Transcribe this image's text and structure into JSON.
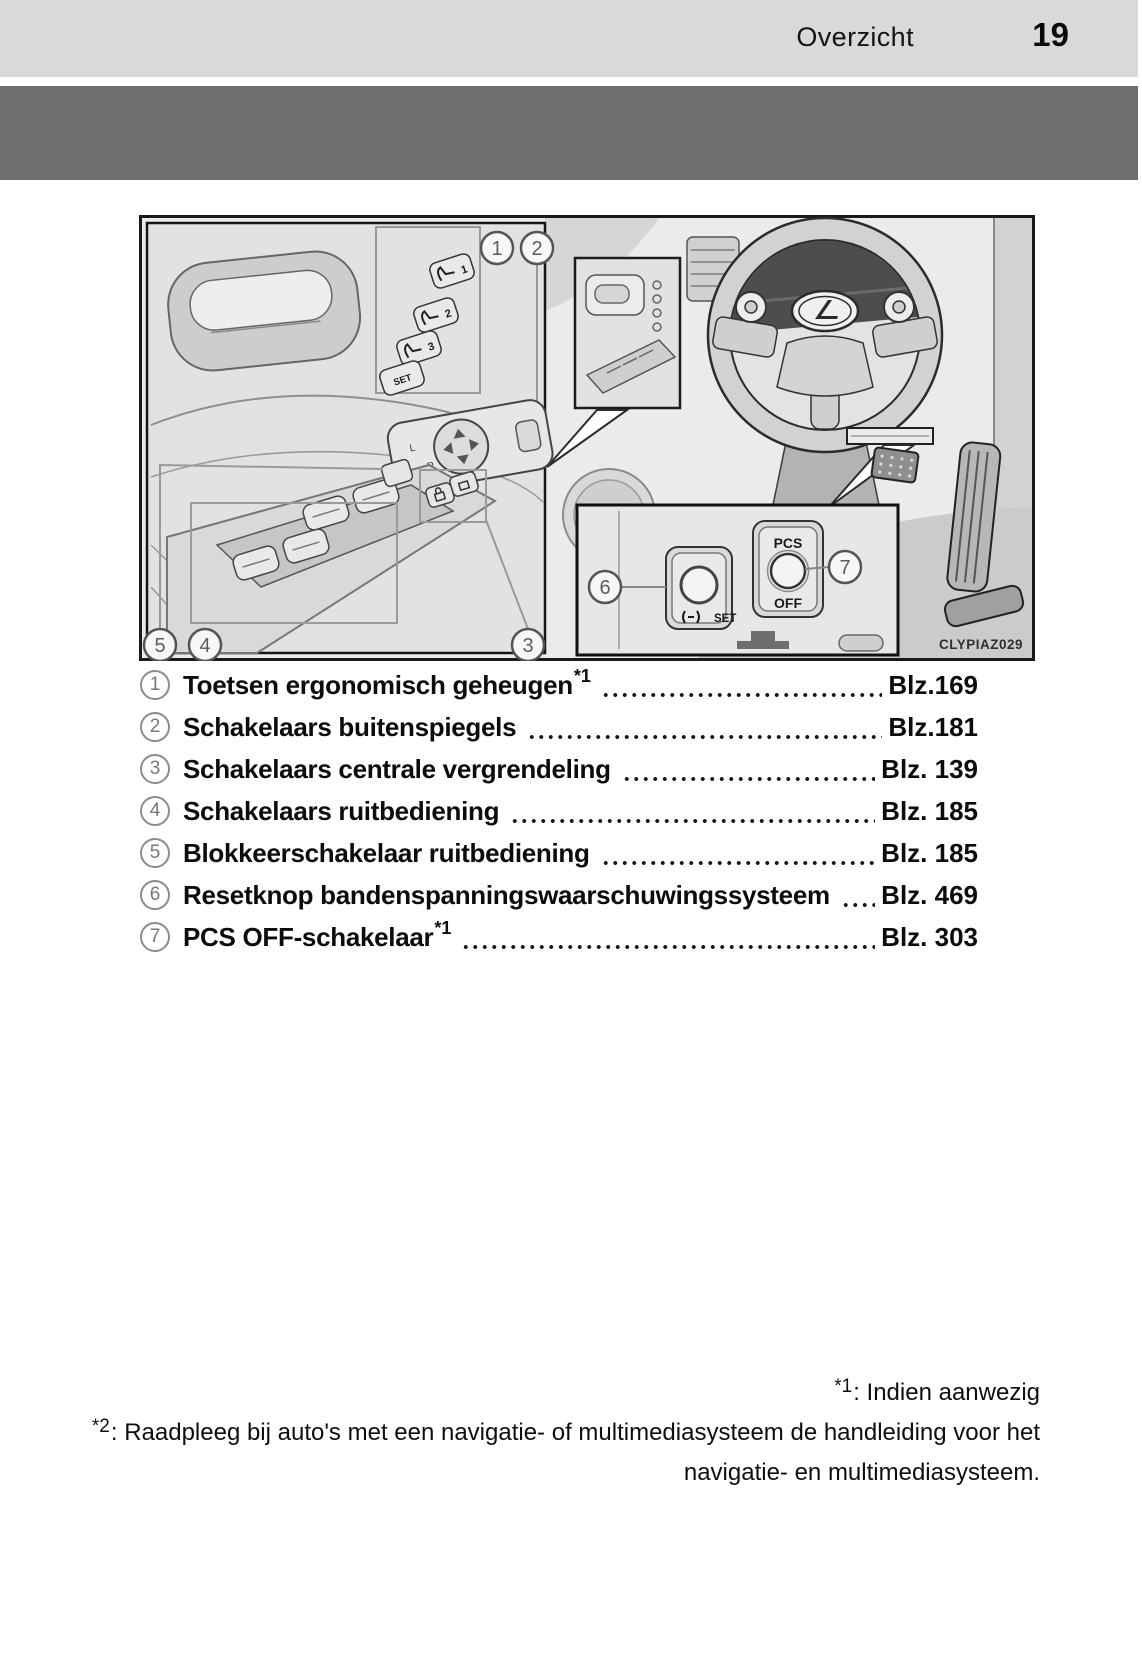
{
  "page": {
    "header": {
      "section_title": "Overzicht",
      "page_number": "19"
    },
    "figure": {
      "image_code": "CLYPIAZ029",
      "callouts": [
        "1",
        "2",
        "3",
        "4",
        "5",
        "6",
        "7"
      ],
      "memory_buttons": [
        "1",
        "2",
        "3",
        "SET"
      ],
      "mirror_switch": {
        "left": "L",
        "right": "R"
      },
      "inset": {
        "set_label": "SET",
        "pcs_line1": "PCS",
        "pcs_line2": "OFF"
      }
    },
    "legend": {
      "items": [
        {
          "num": "1",
          "label": "Toetsen ergonomisch geheugen",
          "sup": "*1",
          "page": "Blz.169"
        },
        {
          "num": "2",
          "label": "Schakelaars buitenspiegels",
          "sup": "",
          "page": "Blz.181"
        },
        {
          "num": "3",
          "label": "Schakelaars centrale vergrendeling",
          "sup": "",
          "page": "Blz. 139"
        },
        {
          "num": "4",
          "label": "Schakelaars ruitbediening",
          "sup": "",
          "page": "Blz. 185"
        },
        {
          "num": "5",
          "label": "Blokkeerschakelaar ruitbediening",
          "sup": "",
          "page": "Blz. 185"
        },
        {
          "num": "6",
          "label": "Resetknop bandenspanningswaarschuwingssysteem",
          "sup": "",
          "page": "Blz. 469"
        },
        {
          "num": "7",
          "label": "PCS OFF-schakelaar",
          "sup": "*1",
          "page": "Blz. 303"
        }
      ]
    },
    "footnotes": {
      "fn1": {
        "marker": "*1",
        "text": ": Indien aanwezig"
      },
      "fn2": {
        "marker": "*2",
        "line1": ": Raadpleeg bij auto's met een navigatie- of multimediasysteem de handleiding voor het",
        "line2": "navigatie- en multimediasysteem."
      }
    },
    "colors": {
      "header_bar": "#d9d9d9",
      "banner": "#6f6f6f"
    }
  }
}
